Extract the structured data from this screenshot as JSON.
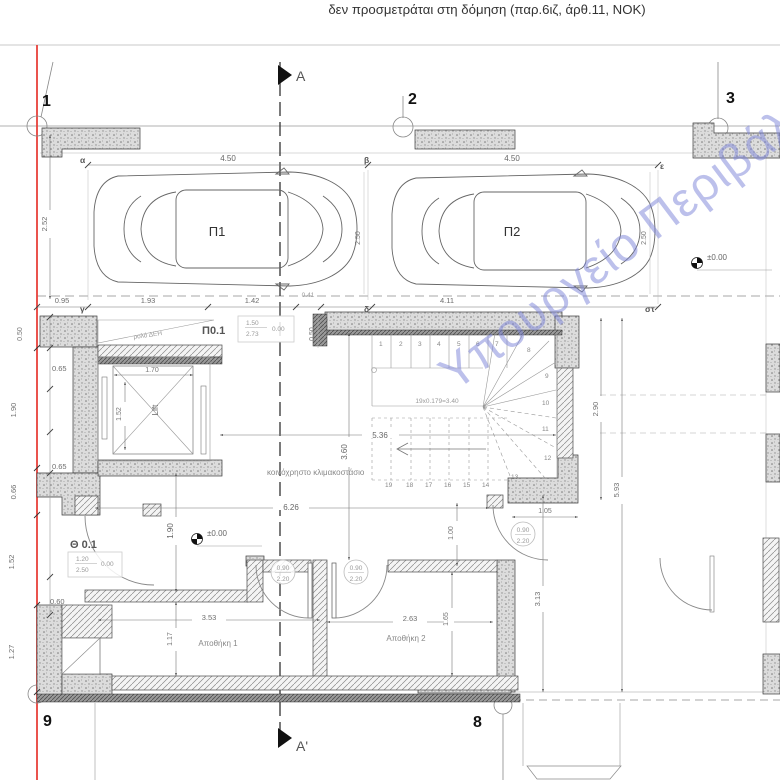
{
  "page": {
    "top_note": "δεν προσμετράται στη δόμηση (παρ.6ιζ, άρθ.11, ΝΟΚ)"
  },
  "watermark": {
    "text": "Υπουργείο Περιβάλλοντος",
    "color": "#7a82d8"
  },
  "colors": {
    "red_guide": "#e8403a",
    "wall_fill": "#dcdcdc",
    "line": "#555555"
  },
  "grid": {
    "n1": "1",
    "n2": "2",
    "n3": "3",
    "n8": "8",
    "n9": "9"
  },
  "section": {
    "top": "A",
    "bottom": "A'"
  },
  "axes": {
    "alpha": "α",
    "beta": "β",
    "gamma": "γ",
    "delta": "δ",
    "epsilon": "ε",
    "sigmatau": "στ"
  },
  "rooms": {
    "parking1": "Π1",
    "parking2": "Π2",
    "storage1": "Αποθήκη 1",
    "storage2": "Αποθήκη 2",
    "stair_hall": "κοινόχρηστο κλιμακοστάσιο",
    "lift": "Lift",
    "roller_door": "ρολό ΔΕΗ"
  },
  "doors": {
    "garage": {
      "code": "Π0.1",
      "w": "1.50",
      "h": "2.73",
      "level": "0.00"
    },
    "entrance": {
      "code": "Θ 0.1",
      "w": "1.20",
      "h": "2.50",
      "level": "0.00"
    },
    "tags": [
      {
        "w": "0.90",
        "h": "2.20"
      },
      {
        "w": "0.90",
        "h": "2.20"
      },
      {
        "w": "0.90",
        "h": "2.20"
      }
    ]
  },
  "levels": {
    "garage": "±0.00",
    "corridor": "±0.00"
  },
  "stairs": {
    "formula": "19x0.179=3.40",
    "steps": [
      "1",
      "2",
      "3",
      "4",
      "5",
      "6",
      "7",
      "8",
      "9",
      "10",
      "11",
      "12",
      "13",
      "14",
      "15",
      "16",
      "17",
      "18",
      "19"
    ]
  },
  "dims": {
    "top1": "4.50",
    "top2": "4.50",
    "v252": "2.52",
    "h095": "0.95",
    "h193": "1.93",
    "h142": "1.42",
    "h041": "0.41",
    "h411": "4.11",
    "v250a": "2.50",
    "v250b": "2.50",
    "v050a": "0.50",
    "v050b": "0.50",
    "h065a": "0.65",
    "h065b": "0.65",
    "v190": "1.90",
    "v066": "0.66",
    "v152": "1.52",
    "h060": "0.60",
    "v127": "1.27",
    "lift_w": "1.70",
    "lift_d": "1.52",
    "h536": "5.36",
    "v360": "3.60",
    "h626": "6.26",
    "v190c": "1.90",
    "v100": "1.00",
    "h105": "1.05",
    "h353": "3.53",
    "v117": "1.17",
    "h263": "2.63",
    "v165": "1.65",
    "v313": "3.13",
    "v593": "5.93",
    "v290": "2.90"
  }
}
